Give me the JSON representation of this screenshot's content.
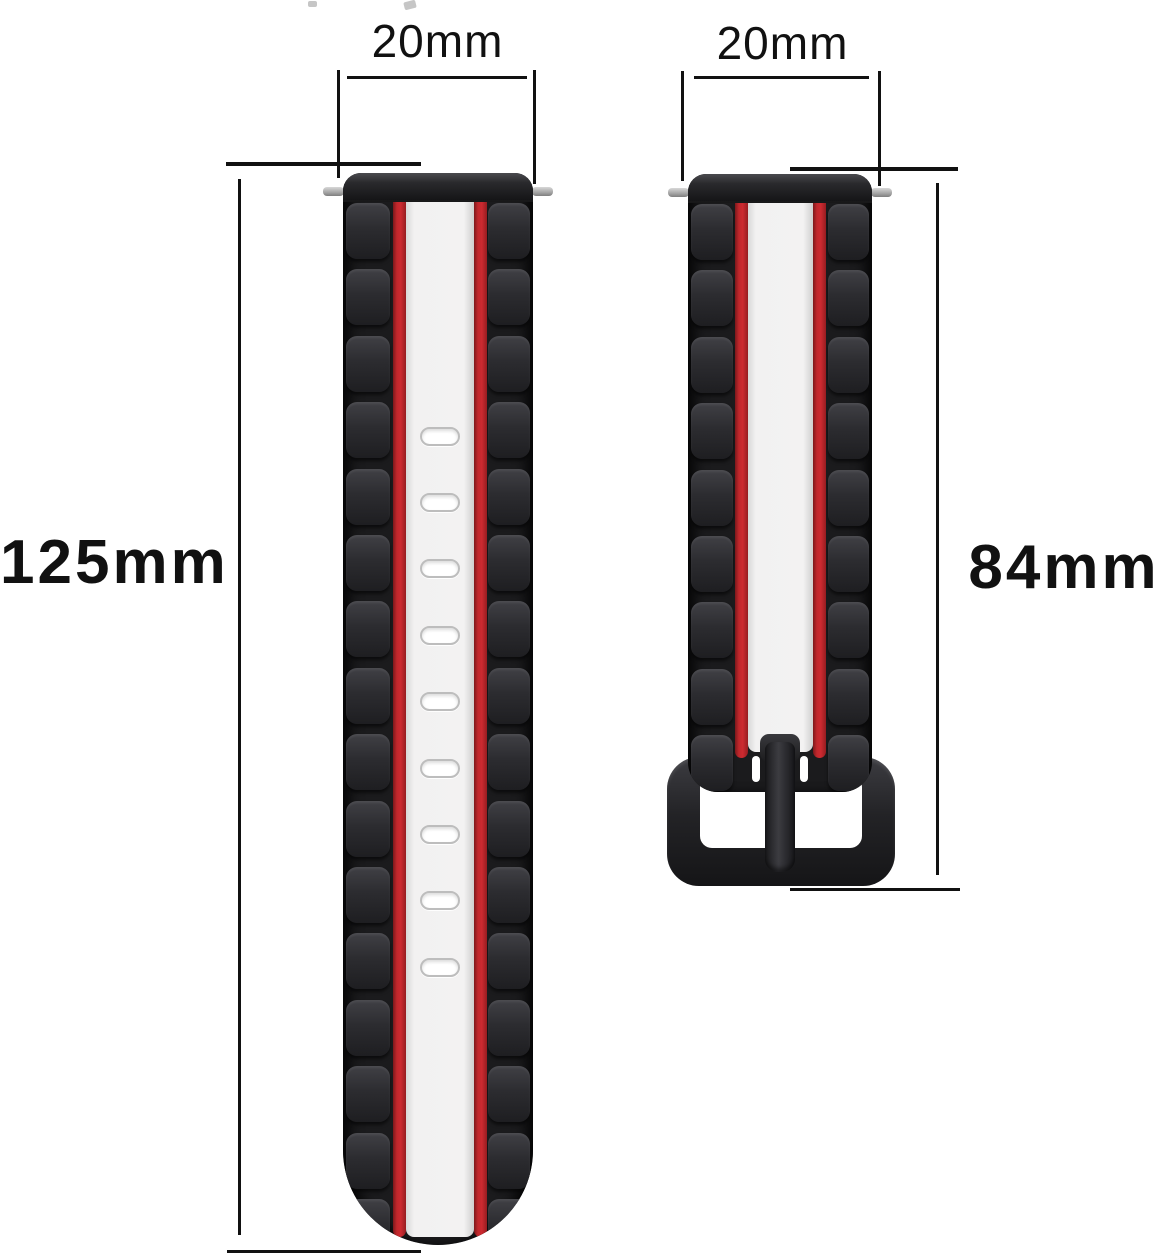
{
  "title": "Watch band size diagram",
  "colors": {
    "background": "#ffffff",
    "annotation_line": "#111111",
    "strap_body": "#232325",
    "stripe_red": "#c4262b",
    "stripe_white": "#f1f0f0",
    "buckle": "#232327",
    "spring_bar": "#a9a9a9"
  },
  "dimensions": {
    "left_band_width": "20mm",
    "right_band_width": "20mm",
    "left_band_length": "125mm",
    "right_band_length": "84mm"
  },
  "left_band": {
    "description": "long tail strap with adjustment holes, black with red and white center stripes",
    "holes": 9,
    "links_per_side": 16
  },
  "right_band": {
    "description": "short buckle strap, black with red and white center stripes, black pin buckle",
    "links_per_side": 9
  }
}
